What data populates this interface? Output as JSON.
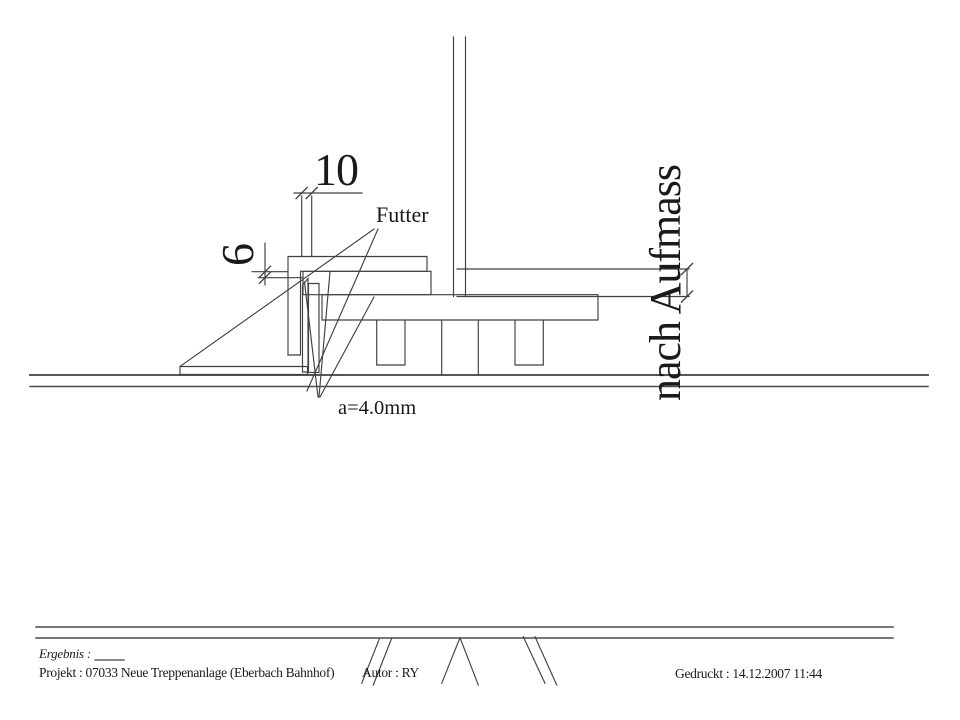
{
  "drawing": {
    "annotations": {
      "dim_horizontal": "10",
      "dim_vertical": "6",
      "part_label": "Futter",
      "weld_spec": "a=4.0mm",
      "site_dimension": "nach Aufmass"
    },
    "title_block": {
      "ergebnis": "Ergebnis :",
      "projekt": "Projekt : 07033  Neue Treppenanlage (Eberbach Bahnhof)",
      "autor": "Autor : RY",
      "gedruckt": "Gedruckt : 14.12.2007  11:44"
    },
    "colors": {
      "line": "#404040",
      "text": "#1a1a1a",
      "background": "#ffffff"
    }
  }
}
